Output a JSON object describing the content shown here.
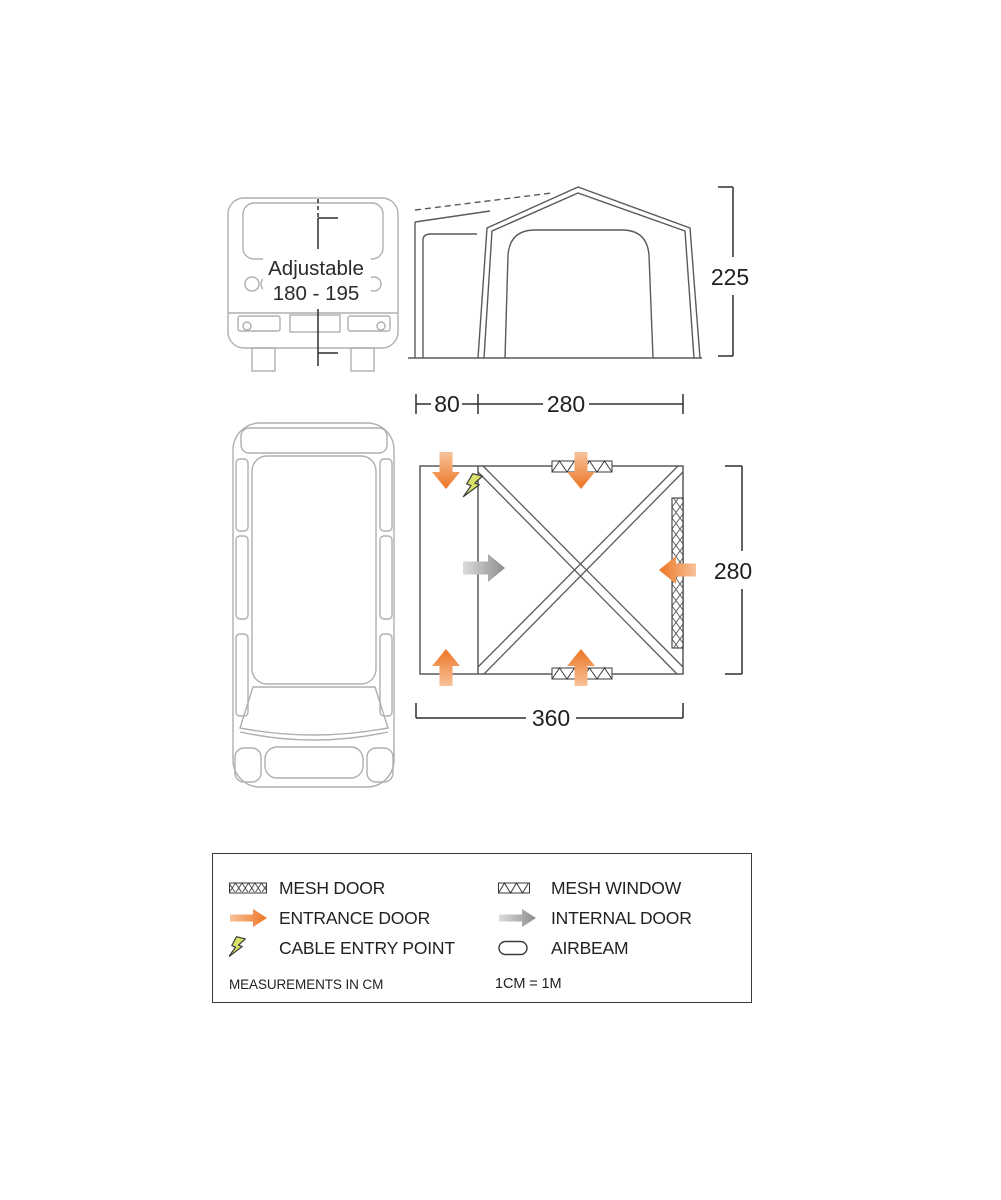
{
  "rear_view": {
    "label_line1": "Adjustable",
    "label_line2": "180 - 195"
  },
  "front_view": {
    "height_dim": "225"
  },
  "plan": {
    "top_dim_80": "80",
    "top_dim_280": "280",
    "right_dim_280": "280",
    "bottom_dim_360": "360"
  },
  "legend": {
    "items": [
      {
        "icon": "mesh-door-icon",
        "label": "MESH DOOR"
      },
      {
        "icon": "entrance-door-icon",
        "label": "ENTRANCE DOOR"
      },
      {
        "icon": "cable-entry-point-icon",
        "label": "CABLE ENTRY POINT"
      },
      {
        "icon": "mesh-window-icon",
        "label": "MESH WINDOW"
      },
      {
        "icon": "internal-door-icon",
        "label": "INTERNAL DOOR"
      },
      {
        "icon": "airbeam-icon",
        "label": "AIRBEAM"
      }
    ],
    "measurements_note": "MEASUREMENTS IN CM",
    "scale_note": "1CM = 1M"
  },
  "colors": {
    "accent_orange": "#ED7524",
    "accent_orange_light": "#F7C299",
    "arrow_gray": "#8C8C8C",
    "bolt_yellow": "#D9E266",
    "line_dark": "#2F2F2F",
    "line_tent": "#5A5A5A",
    "line_vehicle": "#AFAFAF"
  }
}
